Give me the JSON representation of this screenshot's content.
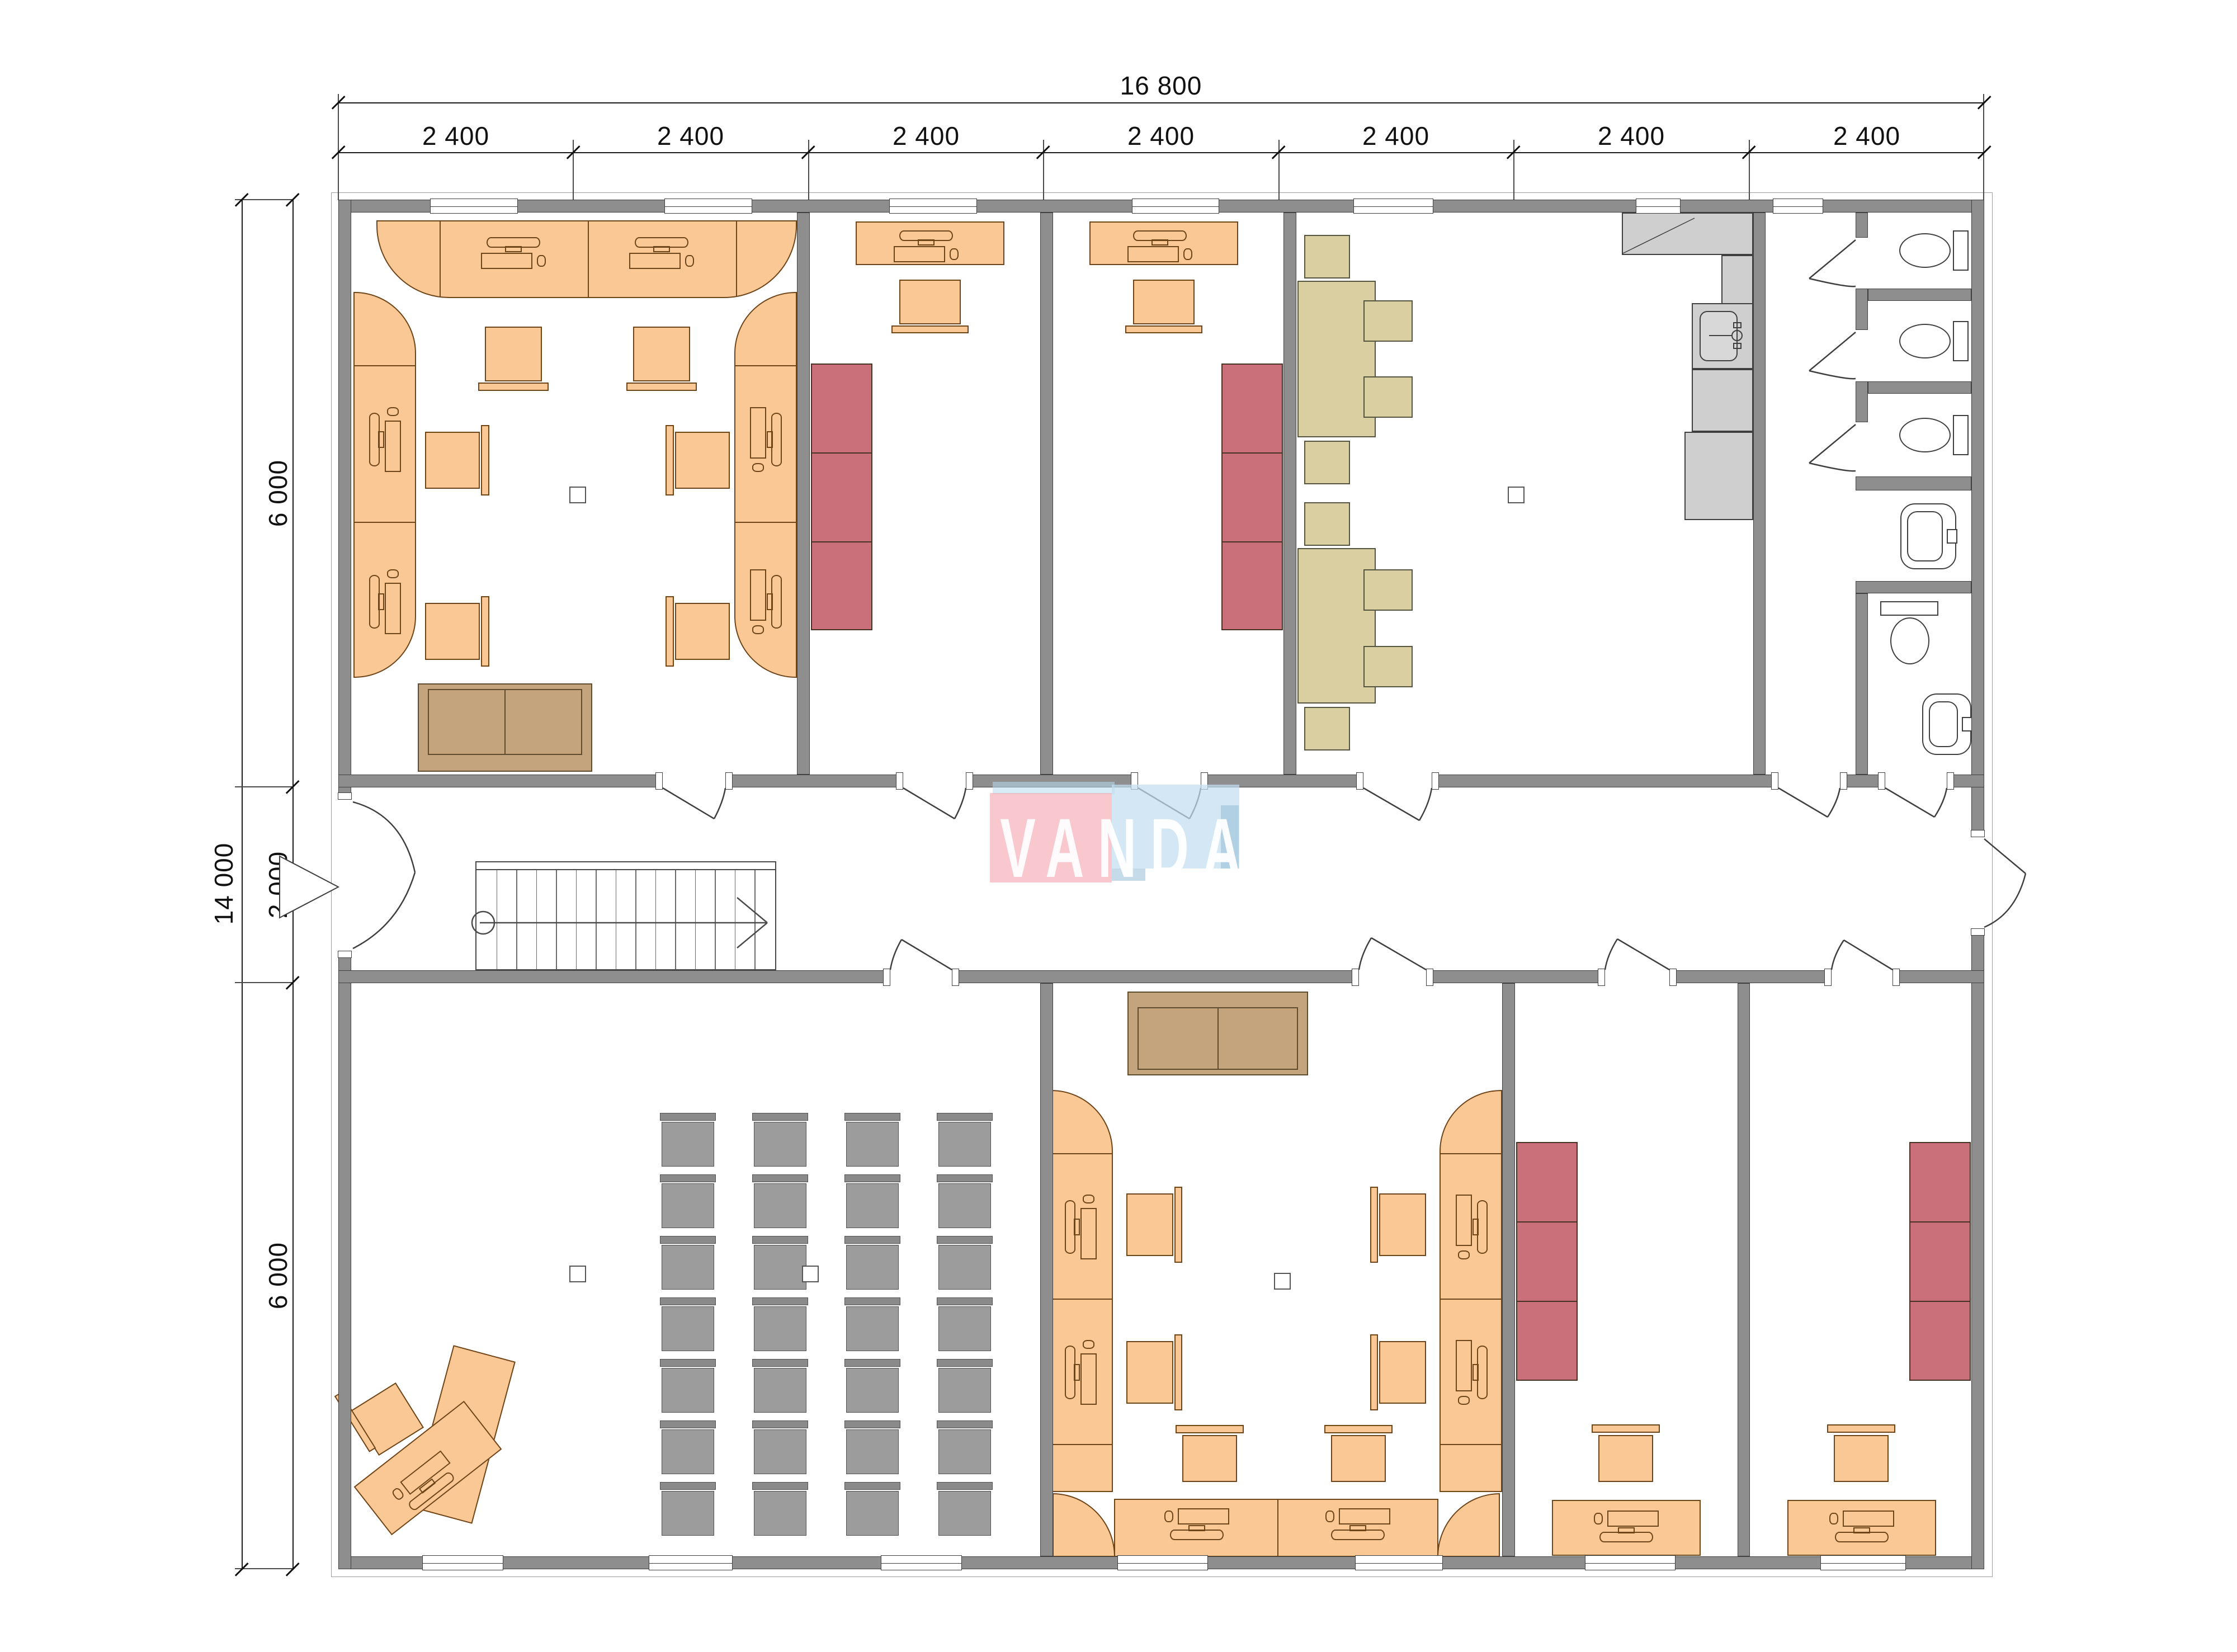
{
  "watermark": {
    "text": "VANDA",
    "pink": "#f4a6b0",
    "blue": "#c4def0"
  },
  "dimensions": {
    "top_total": "16 800",
    "top_segments": [
      "2 400",
      "2 400",
      "2 400",
      "2 400",
      "2 400",
      "2 400",
      "2 400"
    ],
    "left_total": "14 000",
    "left_segments": [
      "6 000",
      "2 000",
      "6 000"
    ]
  },
  "colors": {
    "wall": "#8e8e8e",
    "desk": "#f9c894",
    "cabinet": "#c9707b",
    "table": "#d9cfa1",
    "gray_chair": "#9c9c9c",
    "sofa": "#c4a47c",
    "kitchen_counter": "#cfcfcf",
    "outline": "#3f3f3f"
  }
}
